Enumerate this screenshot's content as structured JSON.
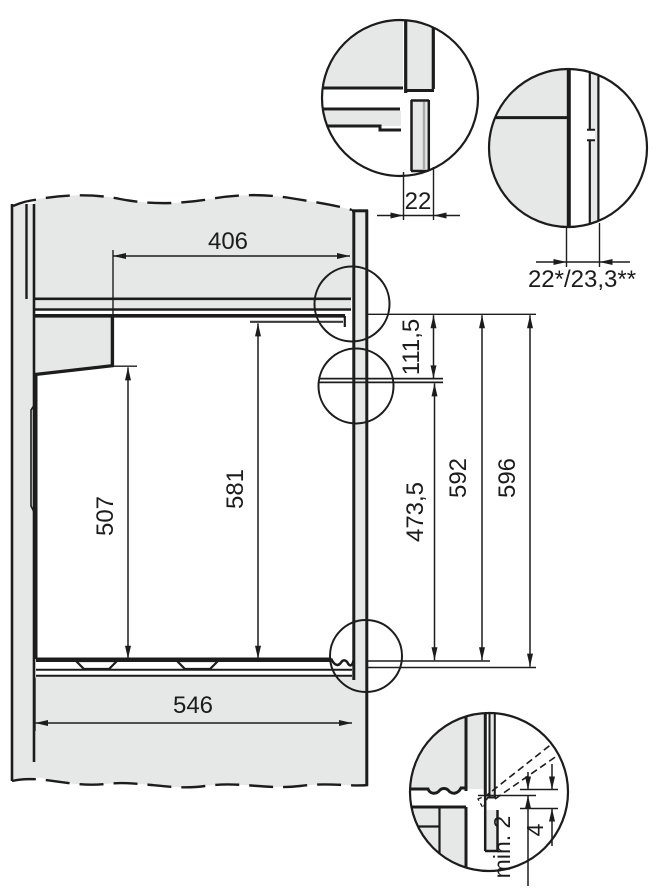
{
  "drawing": {
    "kind": "built-in-oven-niche-installation-diagram",
    "dimensions": {
      "top_depth": "406",
      "panel_thickness": "22",
      "panel_thickness_variants": "22*/23,3**",
      "upper_front_height": "111,5",
      "lower_front_height": "473,5",
      "niche_height": "592",
      "overall_height": "596",
      "rear_height": "507",
      "inner_height": "581",
      "niche_depth": "546",
      "door_bottom_clearance": "min. 2",
      "bottom_reveal": "4"
    },
    "colors": {
      "background": "#ffffff",
      "panel_fill": "#e6e8e7",
      "line": "#1c1c1c",
      "shading": "#a8aca9"
    }
  }
}
